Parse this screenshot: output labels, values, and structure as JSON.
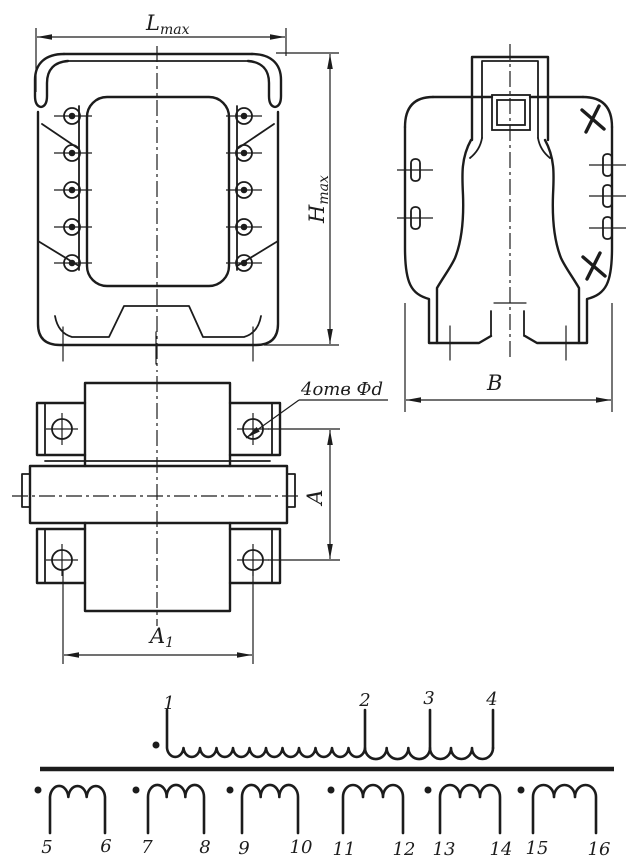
{
  "colors": {
    "ink": "#1c1c1c",
    "paper": "#ffffff"
  },
  "views": {
    "front": {
      "width_label": {
        "main": "L",
        "sub": "max"
      },
      "height_label": {
        "main": "H",
        "sub": "max"
      }
    },
    "side": {
      "width_label": "B"
    },
    "plan": {
      "hole_pitch_vertical_label": "A",
      "hole_pitch_horizontal_label": {
        "main": "A",
        "sub": "1"
      },
      "holes_callout": "4отв Фd"
    }
  },
  "schematic": {
    "primary_terminals": [
      "1",
      "2",
      "3",
      "4"
    ],
    "secondary_windings": [
      {
        "start": "5",
        "end": "6"
      },
      {
        "start": "7",
        "end": "8"
      },
      {
        "start": "9",
        "end": "10"
      },
      {
        "start": "11",
        "end": "12"
      },
      {
        "start": "13",
        "end": "14"
      },
      {
        "start": "15",
        "end": "16"
      }
    ]
  }
}
